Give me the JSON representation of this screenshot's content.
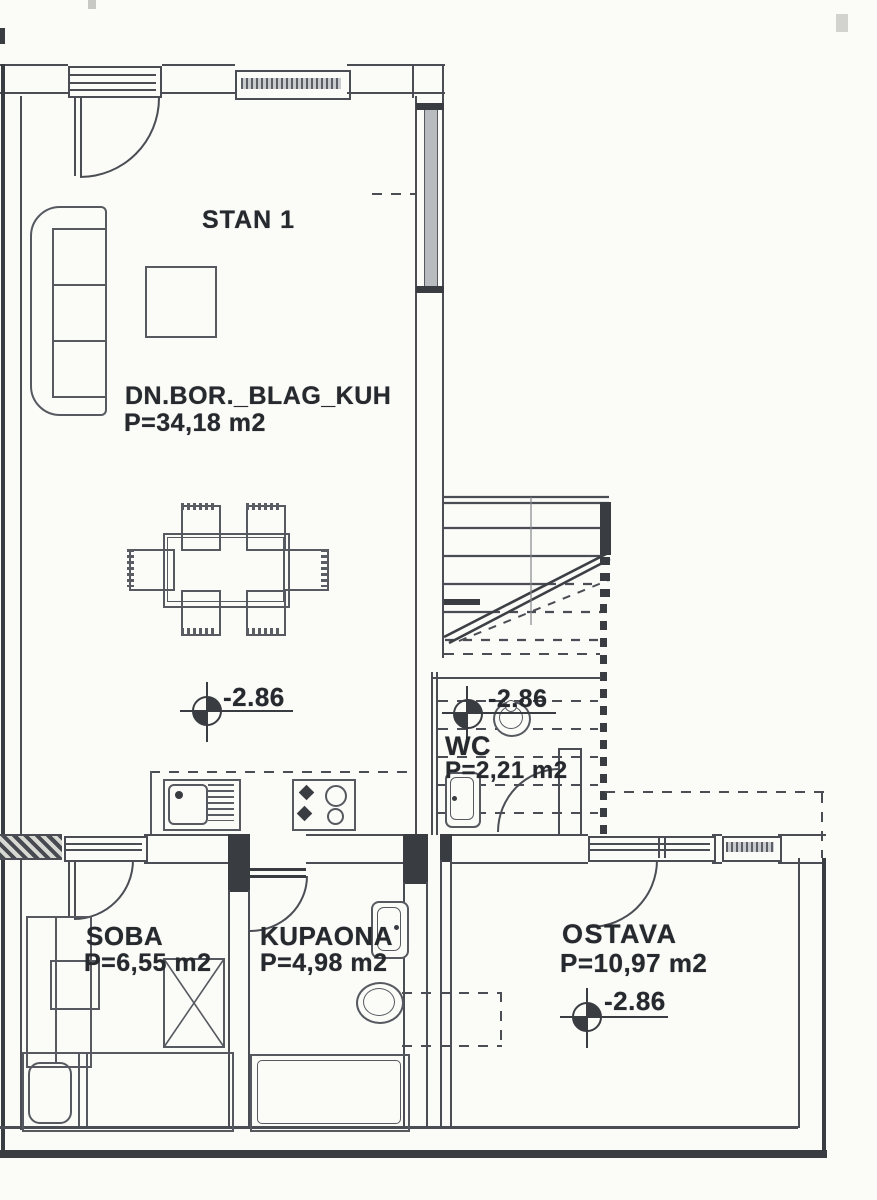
{
  "labels": {
    "apartment": "STAN 1",
    "living": {
      "name": "DN.BOR._BLAG_KUH",
      "area": "P=34,18 m2",
      "elevation": "-2.86"
    },
    "wc": {
      "name": "WC",
      "area": "P=2,21 m2",
      "elevation": "-2.86"
    },
    "soba": {
      "name": "SOBA",
      "area": "P=6,55 m2"
    },
    "kupaona": {
      "name": "KUPAONA",
      "area": "P=4,98 m2"
    },
    "ostava": {
      "name": "OSTAVA",
      "area": "P=10,97 m2",
      "elevation": "-2.86"
    }
  },
  "colors": {
    "wall_line": "#4a4e54",
    "dark_fill": "#393c41",
    "text": "#26292d",
    "background": "#fbfbf8",
    "glazing": "#b9bcbf"
  }
}
